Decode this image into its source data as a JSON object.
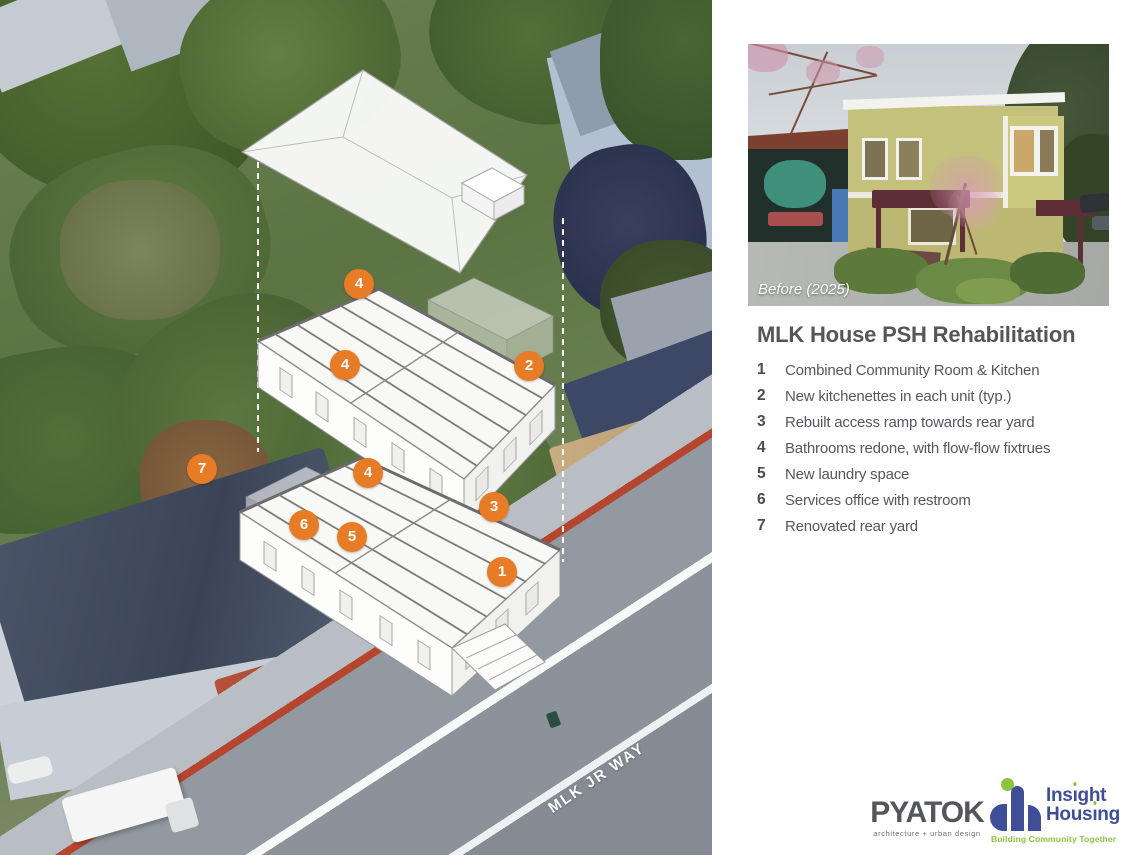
{
  "diagram": {
    "street_label": "MLK JR WAY",
    "markers": [
      {
        "label": "4",
        "x": 359,
        "y": 284
      },
      {
        "label": "4",
        "x": 345,
        "y": 365
      },
      {
        "label": "2",
        "x": 529,
        "y": 366
      },
      {
        "label": "7",
        "x": 202,
        "y": 469
      },
      {
        "label": "4",
        "x": 368,
        "y": 473
      },
      {
        "label": "3",
        "x": 494,
        "y": 507
      },
      {
        "label": "6",
        "x": 304,
        "y": 525
      },
      {
        "label": "5",
        "x": 352,
        "y": 537
      },
      {
        "label": "1",
        "x": 502,
        "y": 572
      }
    ]
  },
  "photo": {
    "caption": "Before (2025)"
  },
  "legend": {
    "title": "MLK House PSH Rehabilitation",
    "items": [
      {
        "num": "1",
        "text": "Combined Community Room & Kitchen"
      },
      {
        "num": "2",
        "text": "New kitchenettes in each unit (typ.)"
      },
      {
        "num": "3",
        "text": "Rebuilt access ramp towards rear yard"
      },
      {
        "num": "4",
        "text": "Bathrooms redone, with flow-flow fixtrues"
      },
      {
        "num": "5",
        "text": "New laundry space"
      },
      {
        "num": "6",
        "text": "Services office with restroom"
      },
      {
        "num": "7",
        "text": "Renovated rear yard"
      }
    ]
  },
  "logos": {
    "pyatok": {
      "name": "PYATOK",
      "tagline": "architecture + urban design"
    },
    "insight": {
      "name_top_pre": "Ins",
      "name_top_post": "ght",
      "name_bottom_pre": "Hous",
      "name_bottom_post": "ng",
      "i_body": "ı",
      "tagline": "Building Community Together",
      "blue": "#3f4e96",
      "green": "#8bc540"
    }
  },
  "colors": {
    "marker_orange": "#e87b25",
    "text_gray": "#54565b"
  }
}
